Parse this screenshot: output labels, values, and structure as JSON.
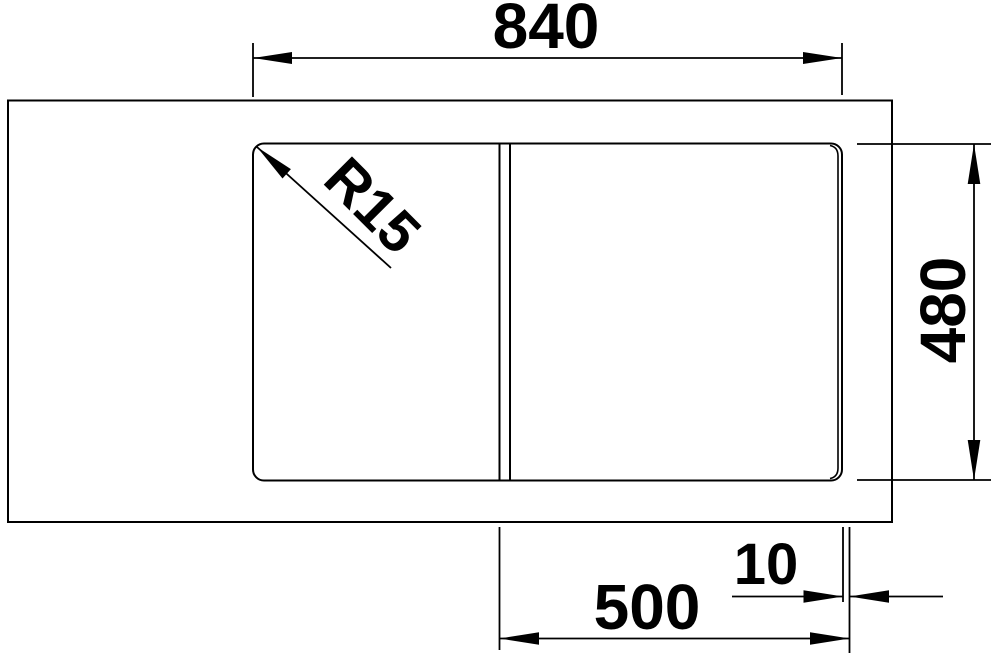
{
  "drawing": {
    "type": "sink-technical-drawing",
    "colors": {
      "background": "#ffffff",
      "line": "#000000",
      "text": "#000000"
    },
    "labels": {
      "top_width": "840",
      "right_height": "480",
      "bottom_bowl_width": "500",
      "bottom_edge_offset": "10",
      "corner_radius": "R15"
    }
  }
}
